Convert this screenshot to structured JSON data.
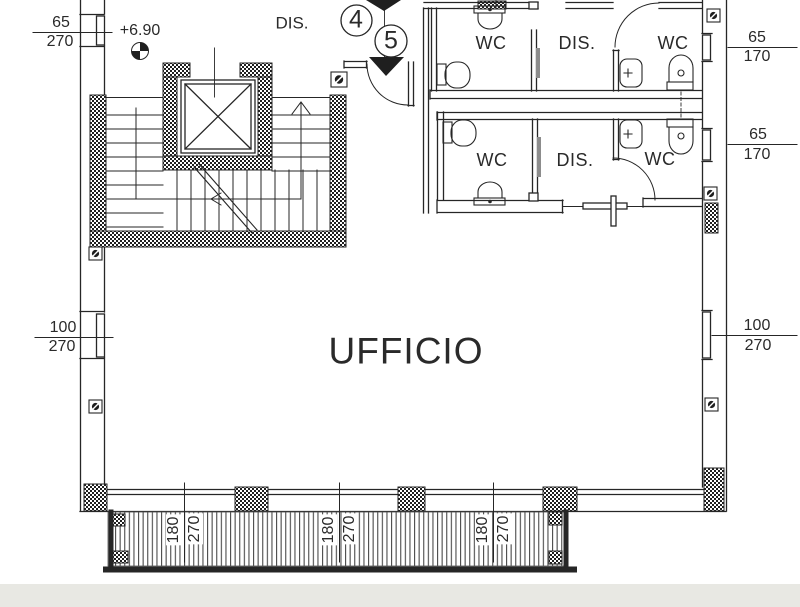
{
  "plan": {
    "office": "UFFICIO",
    "hallway": "DIS.",
    "elevation_level": "+6.90",
    "sections": {
      "s4": "4",
      "s5": "5"
    },
    "toilet_rows": {
      "top": {
        "wc_left": "WC",
        "dis": "DIS.",
        "wc_right": "WC"
      },
      "middle": {
        "wc_left": "WC",
        "dis": "DIS.",
        "wc_right": "WC"
      }
    },
    "dims": {
      "win_left_top": {
        "w": "65",
        "h": "270"
      },
      "win_left_mid": {
        "w": "100",
        "h": "270"
      },
      "win_right_top": {
        "w": "65",
        "h": "170"
      },
      "win_right_mid": {
        "w": "65",
        "h": "170"
      },
      "win_right_low": {
        "w": "100",
        "h": "270"
      },
      "balcony_door_1": {
        "w": "180",
        "h": "270"
      },
      "balcony_door_2": {
        "w": "180",
        "h": "270"
      },
      "balcony_door_3": {
        "w": "180",
        "h": "270"
      }
    },
    "colors": {
      "ink": "#2a2a2a",
      "paper": "#ffffff",
      "scan_edge": "#e8e8e3"
    }
  }
}
